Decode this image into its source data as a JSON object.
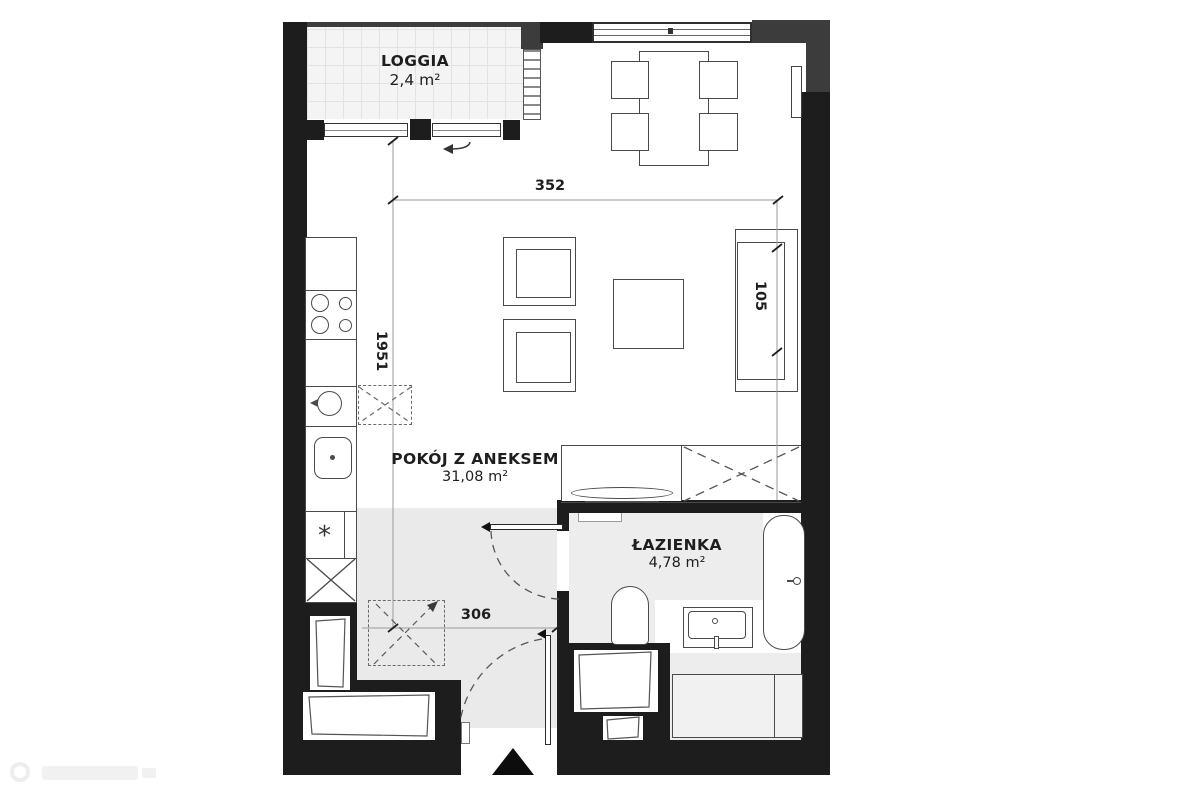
{
  "plan": {
    "type": "apartment-floor-plan",
    "rooms": {
      "loggia": {
        "name": "LOGGIA",
        "area": "2,4 m²"
      },
      "living": {
        "name": "POKÓJ Z ANEKSEM",
        "area": "31,08 m²"
      },
      "bathroom": {
        "name": "ŁAZIENKA",
        "area": "4,78 m²"
      }
    },
    "dimensions": {
      "top_width": "352",
      "left_height": "1951",
      "right_segment": "105",
      "hall_width": "306"
    },
    "symbols": {
      "washer_asterisk": "*"
    },
    "colors": {
      "wall": "#1d1d1d",
      "wall_secondary": "#3c3c3c",
      "hall_floor": "#eaeaea",
      "bath_floor": "#ededed",
      "loggia_tile": "#f4f4f4",
      "outline": "#4a4a4a",
      "text": "#1e1e1e",
      "background": "#ffffff"
    }
  }
}
